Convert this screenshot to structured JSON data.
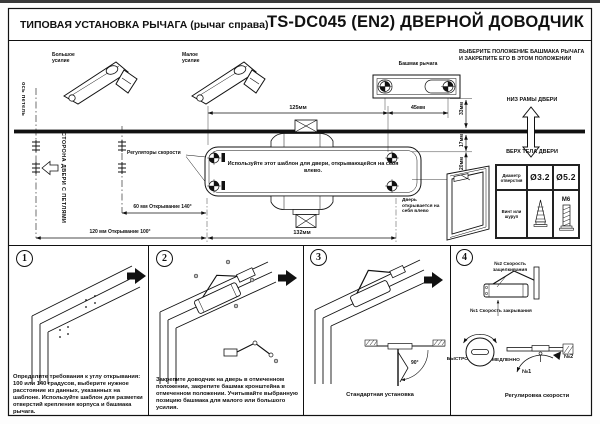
{
  "colors": {
    "ink": "#111111",
    "paper": "#fdfdfd"
  },
  "header": {
    "left_title": "ТИПОВАЯ УСТАНОВКА РЫЧАГА (рычаг справа)",
    "right_title": "TS-DC045 (EN2) ДВЕРНОЙ ДОВОДЧИК"
  },
  "template": {
    "arm_large": "Большое усилие",
    "arm_small": "Малое усилие",
    "hinge_axis": "ось петель",
    "hinge_side": "СТОРОНА ДВЕРИ С ПЕТЛЯМИ",
    "regulators": "Регуляторы скорости",
    "note": "Используйте этот шаблон для двери, открывающейся на себя влево.",
    "shoe_label": "Башмак рычага",
    "dims": {
      "d125": "125мм",
      "d45": "45мм",
      "d33": "33мм",
      "d17": "17мм",
      "d20": "20мм",
      "d132": "132мм",
      "d60": "60 мм   Открывание 140°",
      "d120": "120 мм   Открывание 100°"
    }
  },
  "right_panel": {
    "instruction": "ВЫБЕРИТЕ ПОЛОЖЕНИЕ БАШМАКА РЫЧАГА И ЗАКРЕПИТЕ ЕГО В ЭТОМ ПОЛОЖЕНИИ",
    "frame_bottom": "НИЗ РАМЫ ДВЕРИ",
    "door_top": "ВЕРХ ТЕЛА ДВЕРИ",
    "door_note": "Дверь открывается на себя влево",
    "table": {
      "hole_label": "Диаметр отверстия",
      "hole_small": "Ø3.2",
      "hole_large": "Ø5.2",
      "screw_label": "Винт или шуруп",
      "machine_screw": "М6"
    }
  },
  "steps": [
    {
      "num": "1",
      "caption": "Определите требования к углу открывания: 100 или 140 градусов, выберите нужное расстояние из данных, указанных на шаблоне. Используйте шаблон для разметки отверстий крепления корпуса и башмака рычага."
    },
    {
      "num": "2",
      "caption": "Закрепите доводчик на дверь в отмеченном положении, закрепите башмак кронштейна в отмеченном положении. Учитывайте выбранную позицию башмака для малого или большого усилия."
    },
    {
      "num": "3",
      "caption": "Стандартная установка",
      "angle": "90°"
    },
    {
      "num": "4",
      "caption": "Регулировка скорости",
      "latch_label": "№2 Скорость защелкивания",
      "close_label": "№1 Скорость закрывания",
      "fast": "БЫСТРО",
      "slow": "МЕДЛЕННО",
      "n1": "№1",
      "n2": "№2"
    }
  ]
}
